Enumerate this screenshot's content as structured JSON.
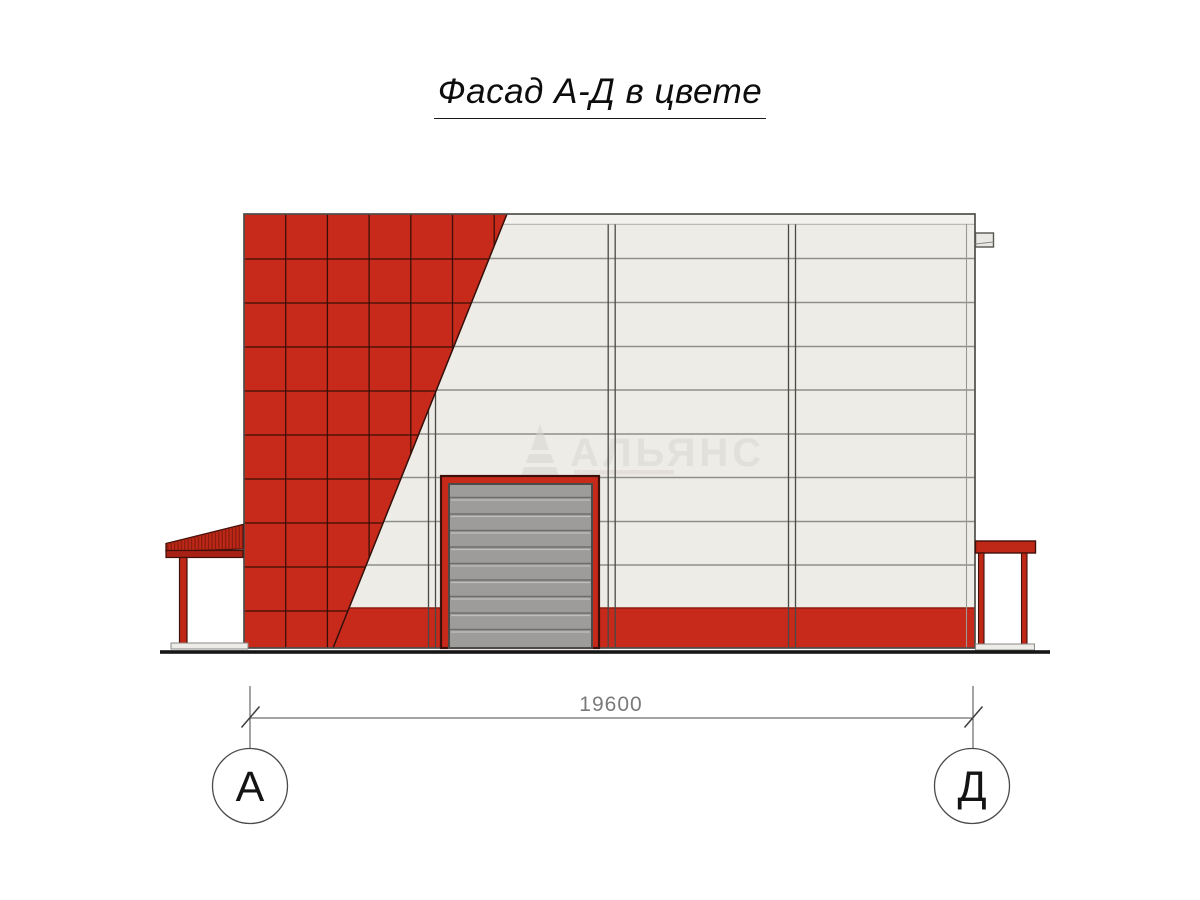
{
  "page": {
    "background": "#ffffff"
  },
  "title": {
    "text": "Фасад А-Д в цвете"
  },
  "drawing": {
    "type": "architectural-elevation",
    "dimension": {
      "value": "19600"
    },
    "axis_markers": [
      {
        "label": "А"
      },
      {
        "label": "Д"
      }
    ],
    "watermark": {
      "text": "АЛЬЯНС"
    },
    "colors": {
      "cladding_red": "#c7291b",
      "tile_joint": "#3a0f07",
      "panel_light": "#edece7",
      "panel_joint": "#90908b",
      "door_gray": "#9d9c9a",
      "door_joint": "#6f6e6c",
      "canopy_red": "#bf2716",
      "ground": "#161616"
    }
  }
}
